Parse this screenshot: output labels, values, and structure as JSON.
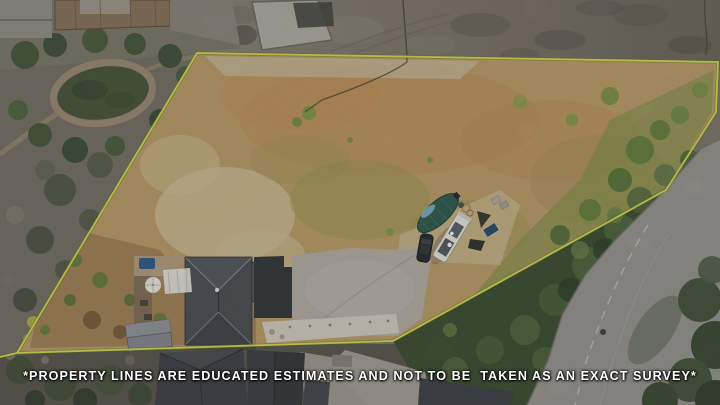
{
  "image": {
    "kind": "aerial-drone-photo-of-vacant-lot-with-property-line-overlay",
    "width_px": 720,
    "height_px": 405
  },
  "disclaimer": {
    "text": "*PROPERTY LINES ARE EDUCATED ESTIMATES AND NOT TO BE  TAKEN AS AN EXACT SURVEY*"
  },
  "colors": {
    "property_line": "#d6e253",
    "property_line_shadow": "#6b701f",
    "disclaimer_text": "#ffffff",
    "field_base": "#c0a068",
    "scrub_top": "#7b7467",
    "scrub_left": "#767266",
    "house_roof": "#4b4e53",
    "garage_roof": "#888b90",
    "driveway": "#b7b2a8",
    "road": "#9a9792",
    "tree_band": "#3b4d2f",
    "pond": "#46543a",
    "boat_cover": "#2d5a4e",
    "boat_bow": "#7fb3c6",
    "rv_body": "#efece6",
    "suv_body": "#25282a",
    "solar_panel": "#2b4a6b",
    "hot_tub": "#2e5c8c",
    "umbrella": "#efece6",
    "gravel": "#d9d3c5"
  }
}
